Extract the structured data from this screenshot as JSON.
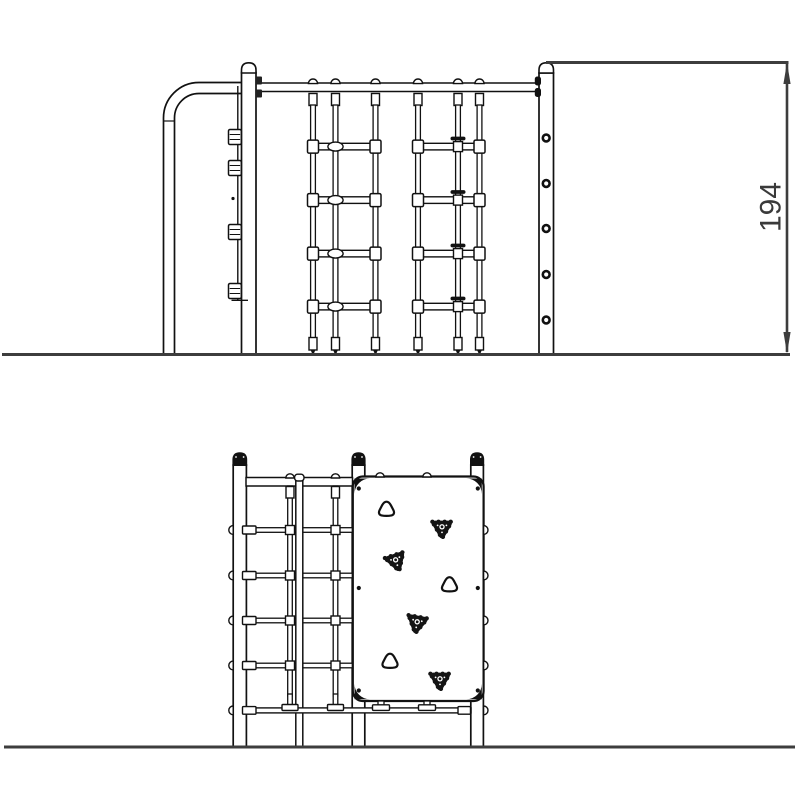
{
  "drawing": {
    "description": "Playground climbing frame technical drawing, side and front elevations",
    "line_color": "#111111",
    "dim_color": "#3d3d3d"
  },
  "dimension": {
    "label": "194",
    "color": "#3d3d3d"
  },
  "side_view": {
    "ground_y": 354.5,
    "rail": {
      "x1": 242,
      "x2": 540.5,
      "y": 83,
      "h": 8.5
    },
    "rope_top_y": 105,
    "rope_bottom_y": 339,
    "rung_centers_y": [
      146.6,
      200.1,
      253.6,
      306.6
    ],
    "ladders": [
      {
        "ropes": [
          313,
          335.5,
          375.5
        ],
        "mid": 335.5,
        "mid_style": "oval"
      },
      {
        "ropes": [
          418,
          458,
          479.5
        ],
        "mid": 458,
        "mid_style": "clamp"
      }
    ],
    "post_holes": {
      "cx": 546.2,
      "ys": [
        138,
        183.5,
        228.5,
        274.5,
        320
      ]
    },
    "clamps": {
      "x": 228.5,
      "w": 12.8,
      "h": 15,
      "tops": [
        129.5,
        160.5,
        224.5,
        283.5
      ]
    }
  },
  "front_view": {
    "post_top_y": 465,
    "ground_y": 747,
    "posts": [
      {
        "x": 233.2,
        "w": 13.2
      },
      {
        "x": 352.2,
        "w": 12.6
      },
      {
        "x": 470.8,
        "w": 12.6
      }
    ],
    "rail": {
      "x1": 246,
      "x2": 352.5,
      "y": 477.5,
      "h": 8.5
    },
    "thin_post": {
      "x": 295.8,
      "w": 7,
      "top": 479
    },
    "net_rows_yc": [
      530,
      575.5,
      620.5,
      665.5
    ],
    "row_x1": 246,
    "row_x2": 352.5,
    "bottom_rope": {
      "yc": 710.4,
      "x1": 246,
      "x2": 471
    },
    "ropes_x": [
      290,
      335.5
    ],
    "rope_top": 486,
    "rope_bottom": 696,
    "left_bump_x": 233.2,
    "right_bump_x": 483.6,
    "edge_bump_ys": [
      530,
      575.5,
      620.5,
      665.5,
      710.4
    ],
    "rail_bump_xs": [
      290,
      335.5
    ],
    "panel": {
      "x": 352.8,
      "y": 476.5,
      "w": 130.8,
      "h": 224.5,
      "r": 10
    },
    "panel_top_bump_xs": [
      380,
      427
    ],
    "feet_xs": [
      381,
      427
    ],
    "panel_dots": [
      [
        358.8,
        488.5
      ],
      [
        477.8,
        488.5
      ],
      [
        358.8,
        588
      ],
      [
        477.8,
        588
      ],
      [
        358.8,
        690.5
      ],
      [
        477.8,
        690.5
      ]
    ],
    "holds": [
      {
        "x": 386.5,
        "y": 509.5,
        "type": "plain",
        "rot": 0
      },
      {
        "x": 442,
        "y": 528,
        "type": "bolted",
        "rot": 0
      },
      {
        "x": 396,
        "y": 561,
        "type": "bolted",
        "rot": -18
      },
      {
        "x": 449.5,
        "y": 585,
        "type": "plain",
        "rot": 0
      },
      {
        "x": 417,
        "y": 623,
        "type": "bolted",
        "rot": 10
      },
      {
        "x": 390,
        "y": 661.5,
        "type": "plain",
        "rot": 0
      },
      {
        "x": 440,
        "y": 680,
        "type": "bolted",
        "rot": 0
      }
    ]
  }
}
